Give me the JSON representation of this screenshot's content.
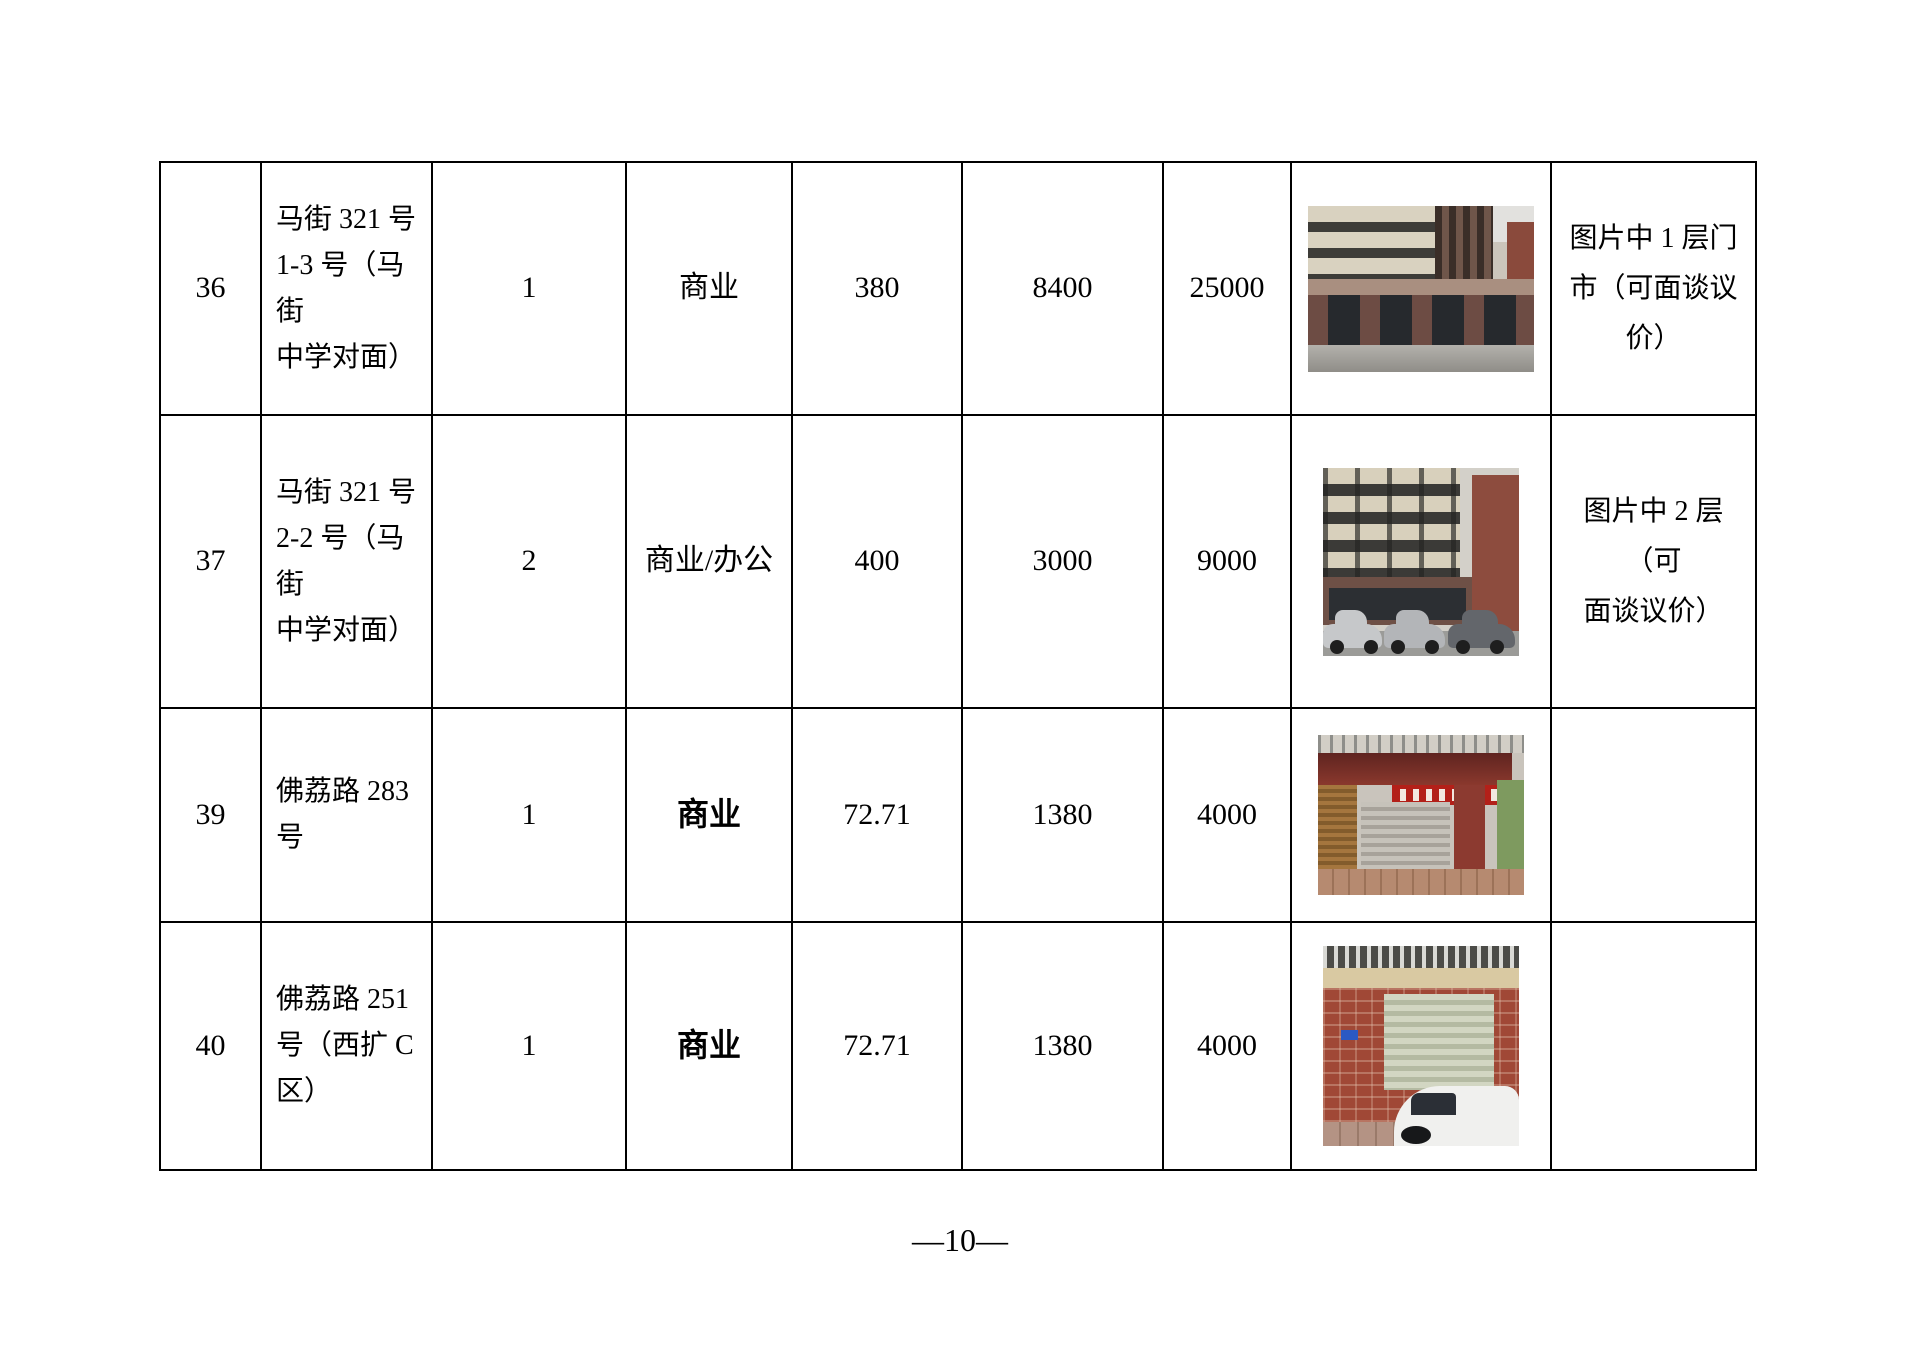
{
  "document": {
    "page_number": "—10—"
  },
  "table": {
    "rows": [
      {
        "num": "36",
        "address_lines": [
          "马街 321 号",
          "1-3 号（马街",
          "中学对面）"
        ],
        "floor": "1",
        "usage": "商业",
        "area": "380",
        "rent": "8400",
        "price": "25000",
        "photo": "多层楼房底层门市照片",
        "note_lines": [
          "图片中 1 层门",
          "市（可面谈议",
          "价）"
        ]
      },
      {
        "num": "37",
        "address_lines": [
          "马街 321 号",
          "2-2 号（马街",
          "中学对面）"
        ],
        "floor": "2",
        "usage": "商业/办公",
        "area": "400",
        "rent": "3000",
        "price": "9000",
        "photo": "临街楼房及停放车辆照片",
        "note_lines": [
          "图片中 2 层（可",
          "面谈议价）"
        ]
      },
      {
        "num": "39",
        "address_lines": [
          "佛荔路 283",
          "号"
        ],
        "floor": "1",
        "usage": "商业",
        "area": "72.71",
        "rent": "1380",
        "price": "4000",
        "photo": "五合生活超市红色雨棚卷帘门门面照片",
        "note_lines": []
      },
      {
        "num": "40",
        "address_lines": [
          "佛荔路 251",
          "号（西扩 C",
          "区）"
        ],
        "floor": "1",
        "usage": "商业",
        "area": "72.71",
        "rent": "1380",
        "price": "4000",
        "photo": "红砖墙卷帘门及白色轿车门面照片",
        "note_lines": []
      }
    ]
  }
}
